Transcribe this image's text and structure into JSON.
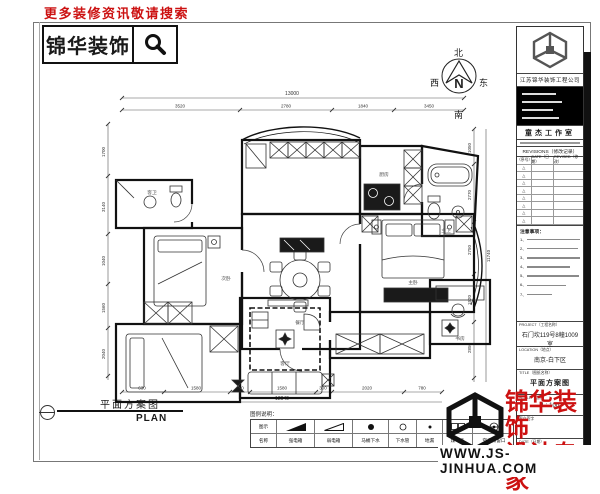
{
  "header": {
    "promo": "更多装修资讯敬请搜索",
    "logo": "锦华装饰"
  },
  "compass": {
    "north": "北",
    "south": "南",
    "east": "东",
    "west": "西",
    "letter": "N"
  },
  "plan": {
    "title": "平面方案图",
    "title_en": "PLAN",
    "rooms": [
      {
        "name": "客卫"
      },
      {
        "name": "次卧"
      },
      {
        "name": "厨房"
      },
      {
        "name": "主卫"
      },
      {
        "name": "主卧"
      },
      {
        "name": "餐厅"
      },
      {
        "name": "客厅"
      },
      {
        "name": "书房"
      }
    ],
    "dims": {
      "top_total": "13000",
      "top_row": [
        "3520",
        "2780",
        "1840",
        "3450"
      ],
      "left_col": [
        "1700",
        "3140",
        "1040",
        "1560",
        "2040"
      ],
      "right_col": [
        "1050",
        "2770",
        "2750",
        "1520",
        "2850"
      ],
      "right_total": "11740",
      "bottom_row": [
        "630",
        "1580",
        "390",
        "1580",
        "300",
        "2020",
        "780"
      ],
      "bottom_total": "12040"
    }
  },
  "legend": {
    "title": "图例说明：",
    "col_symbol": "图示",
    "col_name": "名称",
    "items": [
      {
        "name": "强电箱"
      },
      {
        "name": "弱电箱"
      },
      {
        "name": "马桶下水"
      },
      {
        "name": "下水管"
      },
      {
        "name": "地漏"
      },
      {
        "name": "煤气表"
      },
      {
        "name": "空调预留口"
      }
    ]
  },
  "title_block": {
    "company": "江苏锦华装饰工程公司",
    "studio": "童杰工作室",
    "revisions": "REVISIONS（修改记录）",
    "rev_cols": [
      "（序号）",
      "DATE（日期）",
      "REVISED（修改）"
    ],
    "tri": "△",
    "notes_title": "注意事项：",
    "note_nums": [
      "1、",
      "2、",
      "3、",
      "4、",
      "5、",
      "6、",
      "7、"
    ],
    "project_label": "PROJECT（工程名称）",
    "project_value": "石门坎119号8幢1009室",
    "location_label": "LOCATION（地点）",
    "location_value": "南京-白下区",
    "drawing_label": "TITLE（图纸名称）",
    "drawing_value": "平面方案图",
    "scale_label": "SCALE（比例）",
    "scale_value": "1 : 100",
    "sign_label": "客户签字",
    "date_label": "DATE（日期）"
  },
  "footer": {
    "brand1": "锦华装饰",
    "brand2": "设计专家",
    "website": "WWW.JS-JINHUA.COM"
  },
  "colors": {
    "brand_red": "#cc1111",
    "ink": "#1a1a1a"
  }
}
